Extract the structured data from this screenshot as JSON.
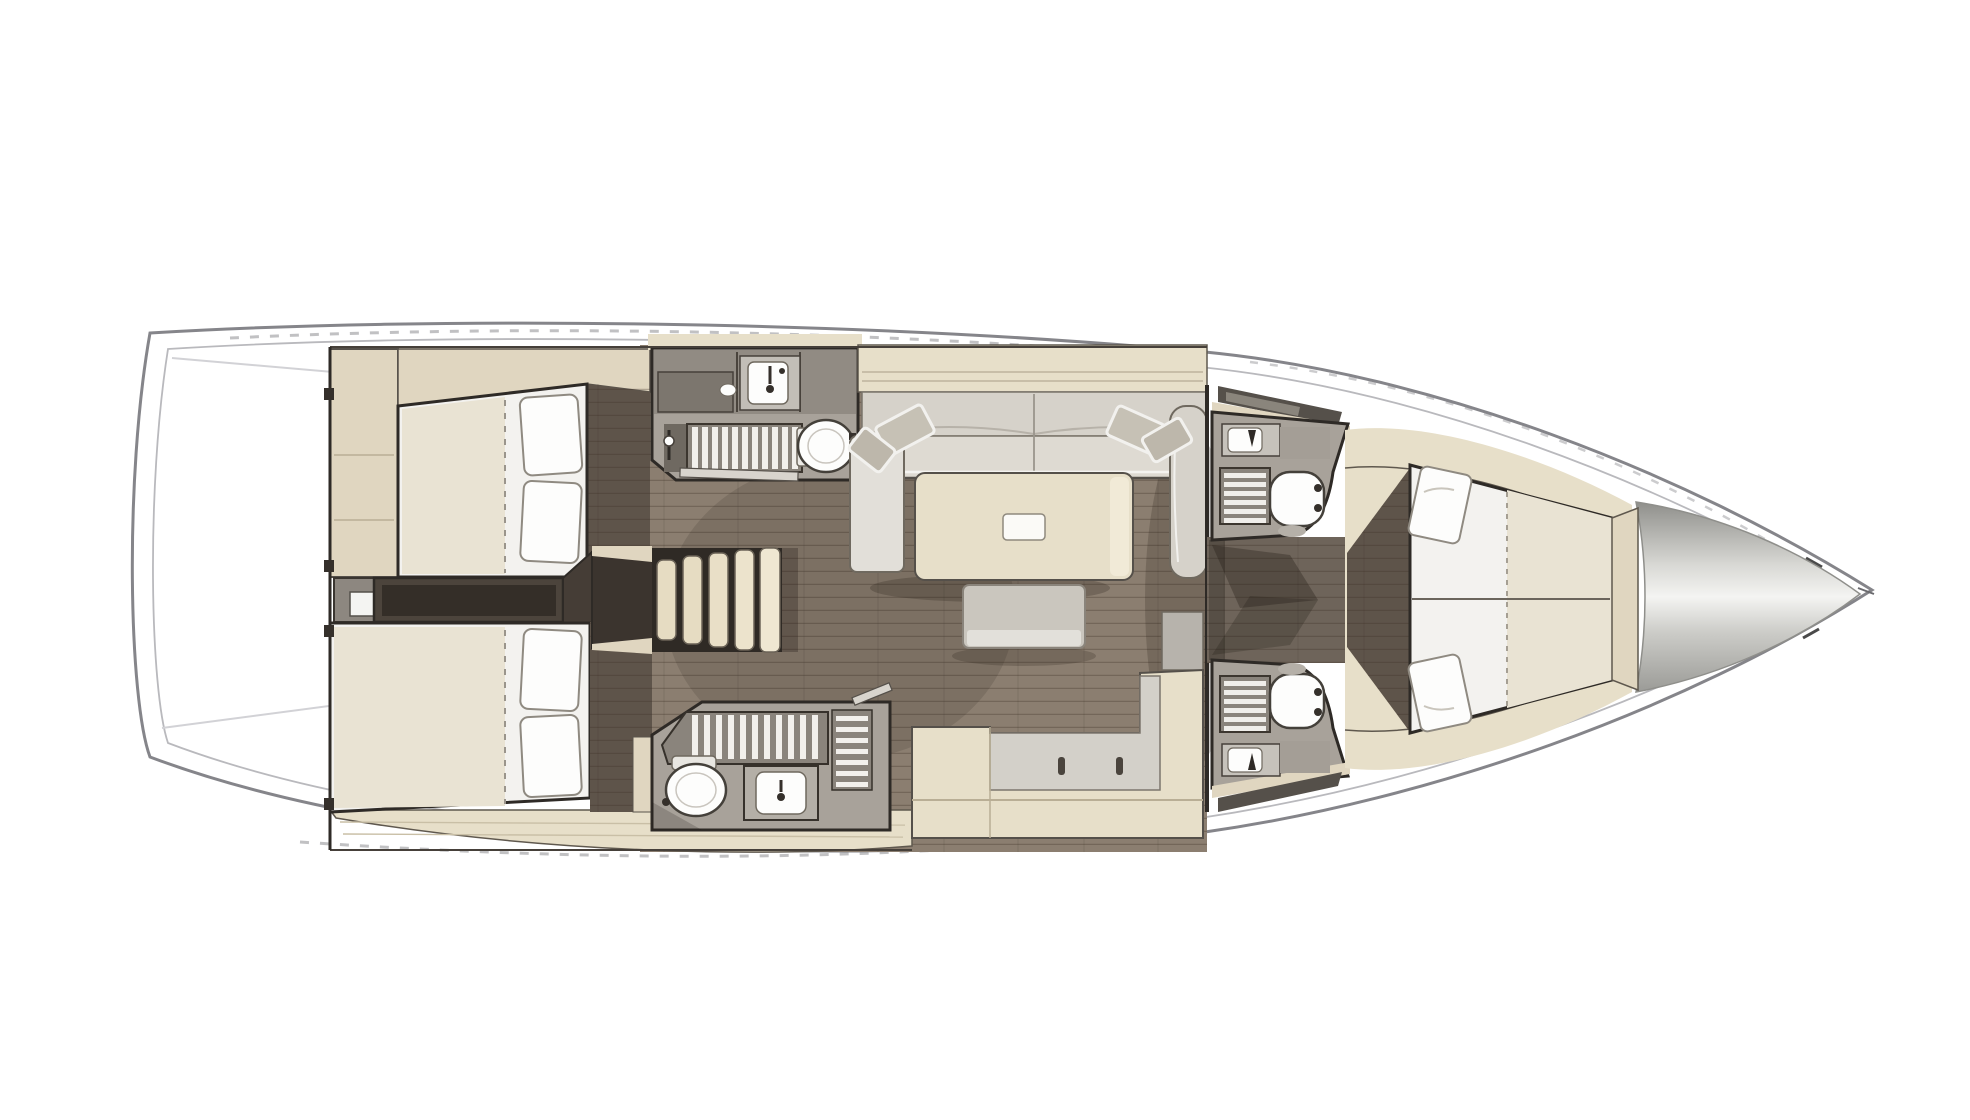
{
  "meta": {
    "title": "Sailing yacht interior layout — top-down deck plan",
    "description": "Rendered floor plan of a sailboat: two aft double cabins, two aft heads with showers, central salon with L-shaped sofa and table, companionway steps, galley, two symmetric forward heads, forward owner's cabin with V-bed, bow locker"
  },
  "canvas": {
    "width": 1970,
    "height": 1120
  },
  "palette": {
    "background": "#ffffff",
    "deck": "#ffffff",
    "hull_line": "#85858a",
    "hull_inner_line": "#b9b9bd",
    "floor_wood": "#8b7e70",
    "floor_dark": "#5e544a",
    "corridor_dark": "#4c443c",
    "joinery_beige": "#e7dfc9",
    "cabinet_beige_dark": "#e0d6c0",
    "mattress_white": "#f3f2ef",
    "mattress_beige": "#e9e3d3",
    "sofa_gray": "#d6d2ca",
    "counter_gray": "#a8a29a",
    "fixture_white": "#fdfdfc",
    "outline_dark": "#2e2a26",
    "bow_highlight": "#f4f4f2",
    "bow_shade": "#90908c",
    "shadow": "rgba(35,28,22,0.35)"
  },
  "regions": {
    "hull": {
      "label": "Hull and deck outline"
    },
    "stern_platform": {
      "label": "Stern swim platform"
    },
    "aft_port_cabin": {
      "label": "Aft double cabin — port"
    },
    "aft_starboard_cabin": {
      "label": "Aft double cabin — starboard"
    },
    "aft_corridor": {
      "label": "Aft passageway between cabins"
    },
    "port_head": {
      "label": "Port aft head with shower, sink and toilet"
    },
    "starboard_head": {
      "label": "Starboard aft head with shower, sink and toilet"
    },
    "companionway": {
      "label": "Companionway steps from cockpit"
    },
    "salon": {
      "label": "Salon with L-shaped sofa, table and bench"
    },
    "galley": {
      "label": "L-shaped galley counter"
    },
    "forward_head_port": {
      "label": "Forward head — port side"
    },
    "forward_head_starboard": {
      "label": "Forward head — starboard side"
    },
    "forward_corridor": {
      "label": "Forward passageway to owner's cabin"
    },
    "forward_cabin": {
      "label": "Forward owner's cabin with V-bed"
    },
    "bow": {
      "label": "Bow anchor locker"
    },
    "mast": {
      "label": "Mast position"
    }
  }
}
